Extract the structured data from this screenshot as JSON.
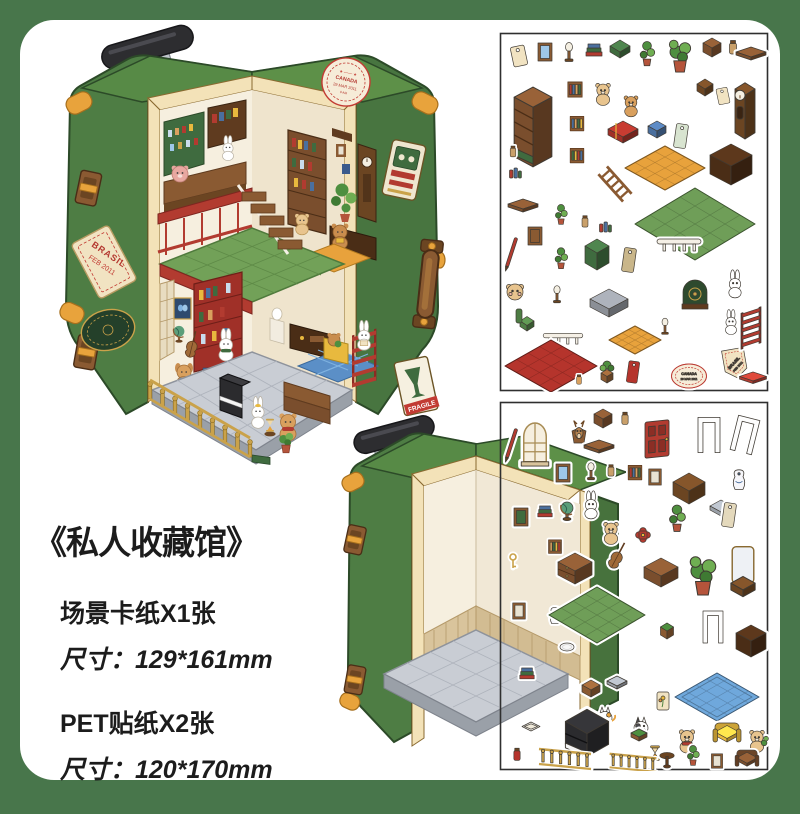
{
  "page": {
    "background": "#48764b",
    "panel": "#ffffff"
  },
  "product": {
    "title": "《私人收藏馆》",
    "specs": [
      {
        "name": "场景卡纸X1张",
        "size": "尺寸：129*161mm"
      },
      {
        "name": "PET贴纸X2张",
        "size": "尺寸：120*170mm"
      }
    ]
  },
  "stamps": {
    "canada": {
      "line1": "CANADA",
      "line2": "29 MAR 2011",
      "line3": "9 AM"
    },
    "brasil": {
      "line1": "BRASIL",
      "line2": "FEB 2011"
    },
    "fragile": "FRAGILE"
  },
  "palette": {
    "case_green": "#4e7d44",
    "case_green_top": "#5d9048",
    "trim_cream": "#f3e2b8",
    "leather_brown": "#8a5a32",
    "gold": "#e8a33c",
    "floor_gray": "#c9cdd4",
    "tile_green": "#72a158",
    "accent_red": "#b23b30"
  },
  "sheet1": {
    "stickers": [
      {
        "k": "tag",
        "x": 20,
        "y": 24
      },
      {
        "k": "frame",
        "x": 46,
        "y": 20,
        "c": "#9ec7e8"
      },
      {
        "k": "lamp",
        "x": 70,
        "y": 22
      },
      {
        "k": "books",
        "x": 95,
        "y": 22
      },
      {
        "k": "box",
        "x": 121,
        "y": 20,
        "c": "#3f6b3f",
        "w": 10,
        "d": 6,
        "h": 6
      },
      {
        "k": "plantv",
        "x": 148,
        "y": 26,
        "s": 1.1
      },
      {
        "k": "plant",
        "x": 181,
        "y": 30,
        "s": 1.25
      },
      {
        "k": "box",
        "x": 213,
        "y": 18,
        "c": "#7a4e2d",
        "w": 9,
        "d": 5,
        "h": 7
      },
      {
        "k": "jar",
        "x": 234,
        "y": 16
      },
      {
        "k": "shelfw",
        "x": 252,
        "y": 24
      },
      {
        "k": "bookcase",
        "x": 34,
        "y": 100,
        "s": 1.45
      },
      {
        "k": "shelfbooks",
        "x": 76,
        "y": 58,
        "s": 0.9
      },
      {
        "k": "bear",
        "x": 104,
        "y": 62,
        "s": 0.95
      },
      {
        "k": "bear",
        "x": 132,
        "y": 74,
        "c": "#d9a05e",
        "s": 0.9
      },
      {
        "k": "shelfbooks",
        "x": 78,
        "y": 92,
        "s": 0.85,
        "o": 1
      },
      {
        "k": "bigbook",
        "x": 124,
        "y": 104
      },
      {
        "k": "box",
        "x": 158,
        "y": 100,
        "c": "#4a6f9e",
        "w": 9,
        "d": 5,
        "h": 6
      },
      {
        "k": "tagv",
        "x": 182,
        "y": 104,
        "c": "#d8e4d0"
      },
      {
        "k": "box",
        "x": 206,
        "y": 58,
        "c": "#6b4522",
        "w": 8,
        "d": 5,
        "h": 6
      },
      {
        "k": "tag",
        "x": 224,
        "y": 64,
        "s": 0.8
      },
      {
        "k": "clock",
        "x": 246,
        "y": 82,
        "s": 1.25
      },
      {
        "k": "jar",
        "x": 14,
        "y": 120,
        "s": 0.8
      },
      {
        "k": "jars",
        "x": 16,
        "y": 142
      },
      {
        "k": "shelfbooks",
        "x": 78,
        "y": 124,
        "s": 0.85,
        "o": 3
      },
      {
        "k": "ladder",
        "x": 116,
        "y": 152,
        "s": 1.15
      },
      {
        "k": "floor",
        "x": 166,
        "y": 136,
        "c": "#e8a23c",
        "w": 40,
        "d": 22
      },
      {
        "k": "box",
        "x": 232,
        "y": 138,
        "c": "#4a2d16",
        "w": 21,
        "d": 11,
        "h": 15
      },
      {
        "k": "shelfw",
        "x": 24,
        "y": 176
      },
      {
        "k": "plantv",
        "x": 62,
        "y": 186,
        "s": 0.9
      },
      {
        "k": "jar",
        "x": 86,
        "y": 190,
        "s": 0.85
      },
      {
        "k": "jars",
        "x": 106,
        "y": 196
      },
      {
        "k": "floor",
        "x": 196,
        "y": 192,
        "c": "#6f9e58",
        "w": 60,
        "d": 36
      },
      {
        "k": "pen",
        "x": 12,
        "y": 222
      },
      {
        "k": "frame",
        "x": 36,
        "y": 204,
        "c": "#8a5a32"
      },
      {
        "k": "plantv",
        "x": 62,
        "y": 230,
        "s": 0.95
      },
      {
        "k": "box",
        "x": 98,
        "y": 226,
        "c": "#3f6b3f",
        "w": 12,
        "d": 7,
        "h": 12
      },
      {
        "k": "tagv",
        "x": 130,
        "y": 228,
        "c": "#c9b68a"
      },
      {
        "k": "rail",
        "x": 180,
        "y": 210
      },
      {
        "k": "bearface",
        "x": 16,
        "y": 260
      },
      {
        "k": "lamp",
        "x": 58,
        "y": 264,
        "s": 0.9
      },
      {
        "k": "chair",
        "x": 28,
        "y": 294,
        "c": "#4e7d44"
      },
      {
        "k": "box",
        "x": 110,
        "y": 276,
        "c": "#8b8f96",
        "w": 19,
        "d": 10,
        "h": 9
      },
      {
        "k": "floor",
        "x": 136,
        "y": 308,
        "c": "#e8a23c",
        "w": 26,
        "d": 14
      },
      {
        "k": "record",
        "x": 196,
        "y": 262
      },
      {
        "k": "bunny",
        "x": 236,
        "y": 254,
        "s": 0.95
      },
      {
        "k": "bunny",
        "x": 232,
        "y": 292,
        "s": 0.85
      },
      {
        "k": "lamp",
        "x": 166,
        "y": 296,
        "s": 0.85
      },
      {
        "k": "rail",
        "x": 64,
        "y": 304,
        "s": 0.9
      },
      {
        "k": "floor",
        "x": 52,
        "y": 334,
        "c": "#b5342c",
        "w": 46,
        "d": 26
      },
      {
        "k": "jar",
        "x": 80,
        "y": 348,
        "c": "#d9a05e",
        "s": 0.7
      },
      {
        "k": "stoolp",
        "x": 108,
        "y": 342
      },
      {
        "k": "tagv",
        "x": 134,
        "y": 340,
        "c": "#b5342c",
        "s": 0.9
      },
      {
        "k": "stampoval",
        "x": 190,
        "y": 344,
        "t1": "CANADA",
        "t2": "29 MAR 2011"
      },
      {
        "k": "brasiltag",
        "x": 236,
        "y": 332,
        "t1": "BRASIL",
        "t2": "FEB 2011"
      },
      {
        "k": "shelfw",
        "x": 254,
        "y": 348,
        "c": "#b23b30",
        "s": 0.9
      },
      {
        "k": "redrack",
        "x": 252,
        "y": 296
      }
    ]
  },
  "sheet2": {
    "stickers": [
      {
        "k": "pen",
        "x": 12,
        "y": 44
      },
      {
        "k": "window",
        "x": 36,
        "y": 42,
        "s": 1.25
      },
      {
        "k": "deer",
        "x": 80,
        "y": 30
      },
      {
        "k": "box",
        "x": 104,
        "y": 20,
        "c": "#7a4e2d",
        "w": 9,
        "d": 5,
        "h": 7
      },
      {
        "k": "jar",
        "x": 126,
        "y": 18,
        "s": 0.9
      },
      {
        "k": "door",
        "x": 158,
        "y": 38,
        "s": 1.2
      },
      {
        "k": "doorframe",
        "x": 210,
        "y": 34,
        "s": 1.1
      },
      {
        "k": "doorframe",
        "x": 246,
        "y": 34,
        "s": 1.1,
        "r": 14
      },
      {
        "k": "shelfw",
        "x": 100,
        "y": 48
      },
      {
        "k": "frame",
        "x": 64,
        "y": 72,
        "c": "#9ec7e8"
      },
      {
        "k": "lamp",
        "x": 92,
        "y": 72,
        "s": 0.9
      },
      {
        "k": "jar",
        "x": 112,
        "y": 70,
        "s": 0.85
      },
      {
        "k": "shelfbooks",
        "x": 136,
        "y": 72,
        "s": 0.85
      },
      {
        "k": "frame",
        "x": 156,
        "y": 76,
        "s": 0.9
      },
      {
        "k": "box",
        "x": 190,
        "y": 92,
        "c": "#6b4522",
        "w": 16,
        "d": 9,
        "h": 11
      },
      {
        "k": "vase",
        "x": 240,
        "y": 78,
        "s": 1.15
      },
      {
        "k": "box",
        "x": 222,
        "y": 110,
        "c": "#9aa0a8",
        "w": 11,
        "d": 6,
        "h": 5
      },
      {
        "k": "frame",
        "x": 22,
        "y": 116,
        "c": "#3f6b3f"
      },
      {
        "k": "books",
        "x": 46,
        "y": 114,
        "s": 0.9
      },
      {
        "k": "globe",
        "x": 68,
        "y": 110
      },
      {
        "k": "bunny",
        "x": 92,
        "y": 106,
        "s": 0.95
      },
      {
        "k": "bear",
        "x": 112,
        "y": 132,
        "s": 0.95
      },
      {
        "k": "shelfbooks",
        "x": 56,
        "y": 146,
        "s": 0.8,
        "o": 2
      },
      {
        "k": "ornament",
        "x": 144,
        "y": 134
      },
      {
        "k": "plantv",
        "x": 178,
        "y": 122,
        "s": 1.2
      },
      {
        "k": "tagv",
        "x": 230,
        "y": 114,
        "c": "#e4d9bc"
      },
      {
        "k": "key",
        "x": 14,
        "y": 160
      },
      {
        "k": "dresser",
        "x": 76,
        "y": 172
      },
      {
        "k": "cello",
        "x": 118,
        "y": 156
      },
      {
        "k": "box",
        "x": 162,
        "y": 176,
        "c": "#7a4e2d",
        "w": 17,
        "d": 9,
        "h": 10
      },
      {
        "k": "plant",
        "x": 204,
        "y": 182,
        "s": 1.5
      },
      {
        "k": "mirror",
        "x": 244,
        "y": 170,
        "s": 1.35
      },
      {
        "k": "frame",
        "x": 20,
        "y": 210,
        "s": 0.9
      },
      {
        "k": "vase",
        "x": 56,
        "y": 214,
        "s": 0.95
      },
      {
        "k": "floor",
        "x": 98,
        "y": 214,
        "c": "#6f9e58",
        "w": 48,
        "d": 28
      },
      {
        "k": "plate",
        "x": 68,
        "y": 246
      },
      {
        "k": "stool",
        "x": 168,
        "y": 232
      },
      {
        "k": "doorframe",
        "x": 214,
        "y": 226
      },
      {
        "k": "box",
        "x": 252,
        "y": 244,
        "c": "#4a2d16",
        "w": 15,
        "d": 8,
        "h": 12
      },
      {
        "k": "books",
        "x": 28,
        "y": 276,
        "s": 0.9
      },
      {
        "k": "box",
        "x": 92,
        "y": 290,
        "c": "#8a5a32",
        "w": 9,
        "d": 5,
        "h": 6
      },
      {
        "k": "box",
        "x": 118,
        "y": 284,
        "c": "#9aa0a8",
        "w": 10,
        "d": 5,
        "h": 4
      },
      {
        "k": "cat",
        "x": 106,
        "y": 316
      },
      {
        "k": "cat2",
        "x": 142,
        "y": 326
      },
      {
        "k": "flower",
        "x": 164,
        "y": 300
      },
      {
        "k": "rug",
        "x": 218,
        "y": 296,
        "c": "#6fa8dc",
        "w": 42,
        "d": 24
      },
      {
        "k": "tray",
        "x": 32,
        "y": 326
      },
      {
        "k": "piano",
        "x": 88,
        "y": 338,
        "s": 1.35
      },
      {
        "k": "bench",
        "x": 140,
        "y": 336
      },
      {
        "k": "hour",
        "x": 156,
        "y": 352,
        "s": 0.9
      },
      {
        "k": "bear2",
        "x": 188,
        "y": 340
      },
      {
        "k": "sofa",
        "x": 228,
        "y": 336,
        "c": "#e8b93e"
      },
      {
        "k": "bearp",
        "x": 258,
        "y": 340,
        "s": 0.95
      },
      {
        "k": "jar",
        "x": 18,
        "y": 354,
        "c": "#b5342c",
        "s": 0.9
      },
      {
        "k": "balusters",
        "x": 66,
        "y": 356
      },
      {
        "k": "balusters",
        "x": 134,
        "y": 360,
        "s": 0.9
      },
      {
        "k": "table",
        "x": 168,
        "y": 360,
        "s": 0.9
      },
      {
        "k": "plantv",
        "x": 194,
        "y": 358,
        "s": 0.9
      },
      {
        "k": "frame",
        "x": 218,
        "y": 360,
        "s": 0.8
      },
      {
        "k": "sofa",
        "x": 248,
        "y": 361,
        "c": "#7a4e2d",
        "s": 0.85
      }
    ]
  }
}
